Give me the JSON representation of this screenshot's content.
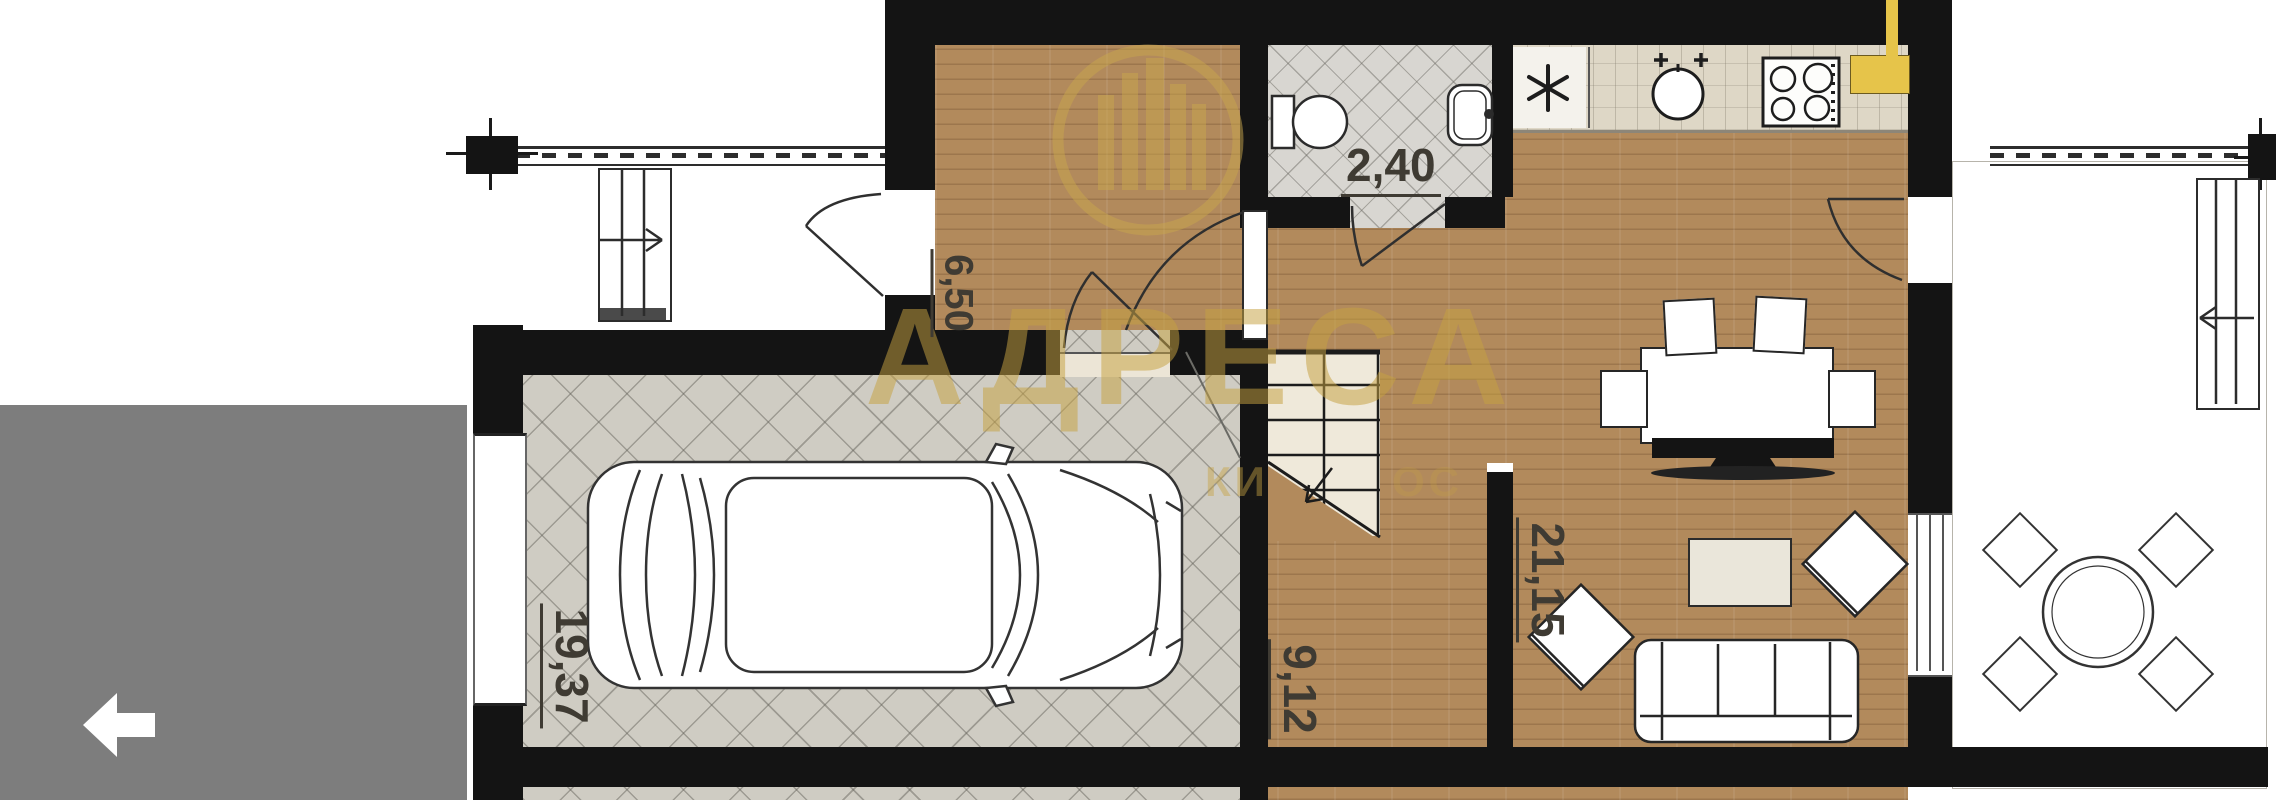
{
  "plan": {
    "rooms": [
      {
        "id": "garage",
        "area_label": "19,37"
      },
      {
        "id": "entry-hall",
        "area_label": "6,50"
      },
      {
        "id": "wc",
        "area_label": "2,40"
      },
      {
        "id": "corridor-stairs",
        "area_label": "9,12"
      },
      {
        "id": "living-kitchen",
        "area_label": "21,15"
      }
    ],
    "fixtures": [
      "car",
      "staircase",
      "toilet",
      "washbasin",
      "kitchen-sink",
      "cooktop",
      "refrigerator-asterisk",
      "dining-table",
      "dining-chairs",
      "tv",
      "coffee-table",
      "armchairs",
      "sofa",
      "terrace-round-table",
      "terrace-chairs",
      "entry-steps",
      "terrace-steps",
      "railings"
    ],
    "colors": {
      "wall": "#141414",
      "wood_floor": "#b28a5c",
      "garage_tile": "#cfccc3",
      "bath_tile": "#d8d6d1",
      "counter": "#ded7c6",
      "accent_yellow": "#e6c44a",
      "watermark_gold": "#c9a74e",
      "viewer_overlay_gray": "#7d7d7d"
    }
  },
  "watermark": {
    "title": "АДРЕСА",
    "fragments": [
      "КИ",
      "ОС"
    ]
  }
}
